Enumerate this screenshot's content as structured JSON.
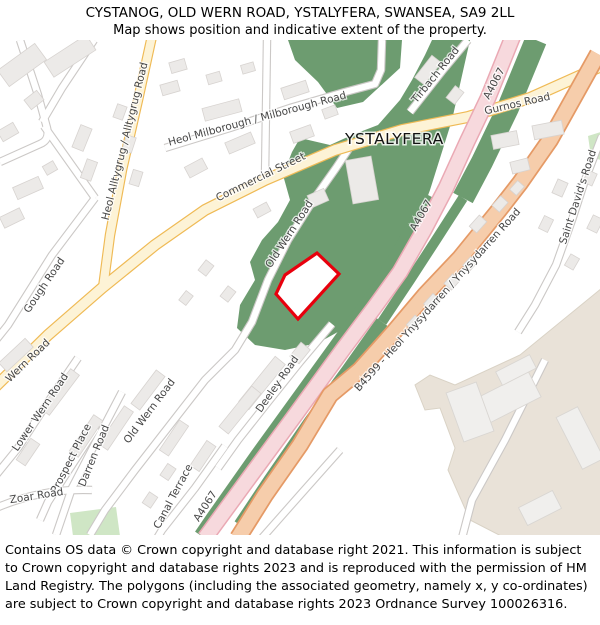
{
  "header": {
    "line1": "CYSTANOG, OLD WERN ROAD, YSTALYFERA, SWANSEA, SA9 2LL",
    "line2": "Map shows position and indicative extent of the property."
  },
  "map": {
    "place_label": "YSTALYFERA",
    "road_labels": [
      {
        "text": "Heol Alltygrug / Alltygrug Road"
      },
      {
        "text": "Heol Milborough / Milborough Road"
      },
      {
        "text": "Commercial Street"
      },
      {
        "text": "Tirbach Road"
      },
      {
        "text": "Gurnos Road"
      },
      {
        "text": "A4067"
      },
      {
        "text": "A4067"
      },
      {
        "text": "A4067"
      },
      {
        "text": "B4599 - Heol Ynysydarren / Ynysydarren Road"
      },
      {
        "text": "Saint David's Road"
      },
      {
        "text": "Old Wern Road"
      },
      {
        "text": "Gough Road"
      },
      {
        "text": "Wern Road"
      },
      {
        "text": "Lower Wern Road"
      },
      {
        "text": "Prospect Place"
      },
      {
        "text": "Darren Road"
      },
      {
        "text": "Old Wern Road"
      },
      {
        "text": "Zoar Road"
      },
      {
        "text": "Canal Terrace"
      },
      {
        "text": "Deeley Road"
      }
    ],
    "colors": {
      "woodland": "#6d9c70",
      "park": "#cfe6c5",
      "road_yellow": "#fdf3d6",
      "road_yellow_casing": "#efba55",
      "road_pink": "#f7d9dd",
      "road_pink_casing": "#eaa9b4",
      "road_salmon": "#f6cdab",
      "road_salmon_casing": "#e59a66",
      "road_white": "#ffffff",
      "road_white_casing": "#cbc8c6",
      "building": "#eceae8",
      "building_stroke": "#d7d3d0",
      "beige": "#e9e2d8",
      "property_outline": "#e8000d",
      "label": "#464646",
      "place": "#111111"
    }
  },
  "footer": {
    "text": "Contains OS data © Crown copyright and database right 2021. This information is subject to Crown copyright and database rights 2023 and is reproduced with the permission of HM Land Registry. The polygons (including the associated geometry, namely x, y co-ordinates) are subject to Crown copyright and database rights 2023 Ordnance Survey 100026316."
  }
}
